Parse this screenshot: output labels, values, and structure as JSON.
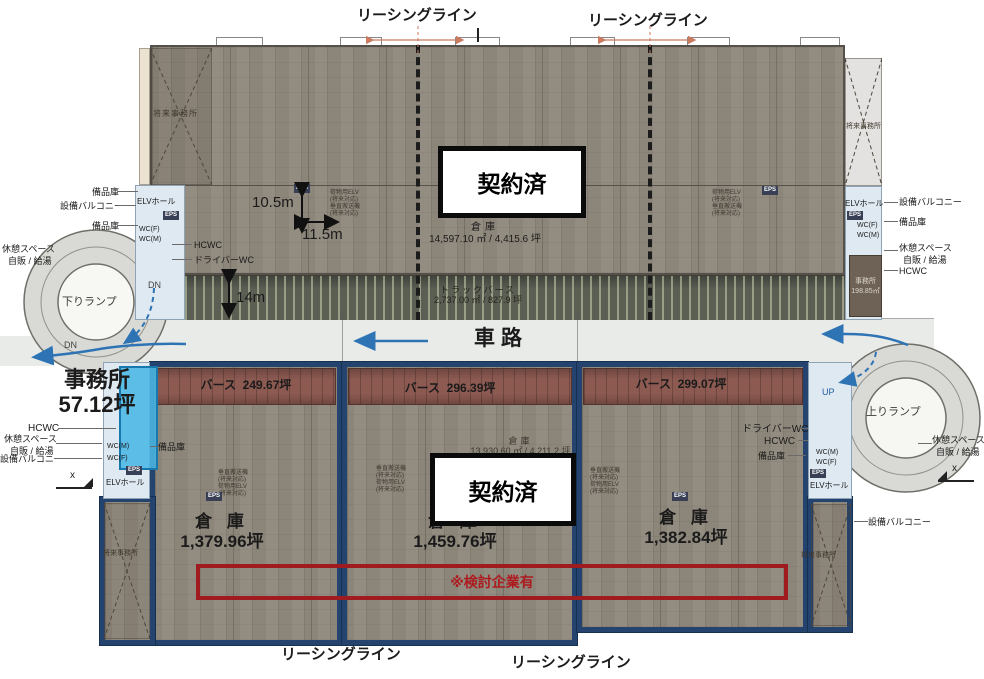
{
  "leasing": {
    "label": "リーシングライン"
  },
  "contracted": {
    "label": "契約済"
  },
  "road": {
    "label": "車路"
  },
  "ramps": {
    "down": "下りランプ",
    "up": "上りランプ",
    "dn": "DN",
    "up_short": "UP"
  },
  "common": {
    "future_office": "将来事務所",
    "bihinko": "備品庫",
    "setsubi_balcony": "設備バルコニー",
    "rest_space": "休憩スペース",
    "vending": "自販 / 給湯",
    "hcwc": "HCWC",
    "driver_wc": "ドライバーWC",
    "wc_f": "WC(F)",
    "wc_m": "WC(M)",
    "eps": "EPS",
    "elv_hall": "ELVホール",
    "elv_note_1": "荷物用ELV",
    "elv_note_2": "垂直搬送機",
    "elv_note_sub": "(将来対応)",
    "x_mark": "x"
  },
  "upper": {
    "warehouse": "倉庫",
    "warehouse_area": "14,597.10 ㎡ / 4,415.6 坪",
    "truck_berth": "トラックバース",
    "truck_berth_area": "2,737.00 ㎡ / 827.9 坪",
    "dim_v": "10.5m",
    "dim_h": "11.5m",
    "dim_dock": "14m",
    "office": "事務所",
    "office_area": "198.85㎡"
  },
  "lower": {
    "office": "事務所",
    "office_area": "57.12坪",
    "note": "※検討企業有",
    "total_warehouse": "倉庫",
    "total_warehouse_area": "13,930.60 ㎡ / 4,211.2 坪",
    "units": [
      {
        "berth": "バース",
        "berth_area": "249.67坪",
        "warehouse": "倉 庫",
        "warehouse_area": "1,379.96坪"
      },
      {
        "berth": "バース",
        "berth_area": "296.39坪",
        "warehouse": "倉 庫",
        "warehouse_area": "1,459.76坪"
      },
      {
        "berth": "バース",
        "berth_area": "299.07坪",
        "warehouse": "倉 庫",
        "warehouse_area": "1,382.84坪"
      }
    ]
  }
}
